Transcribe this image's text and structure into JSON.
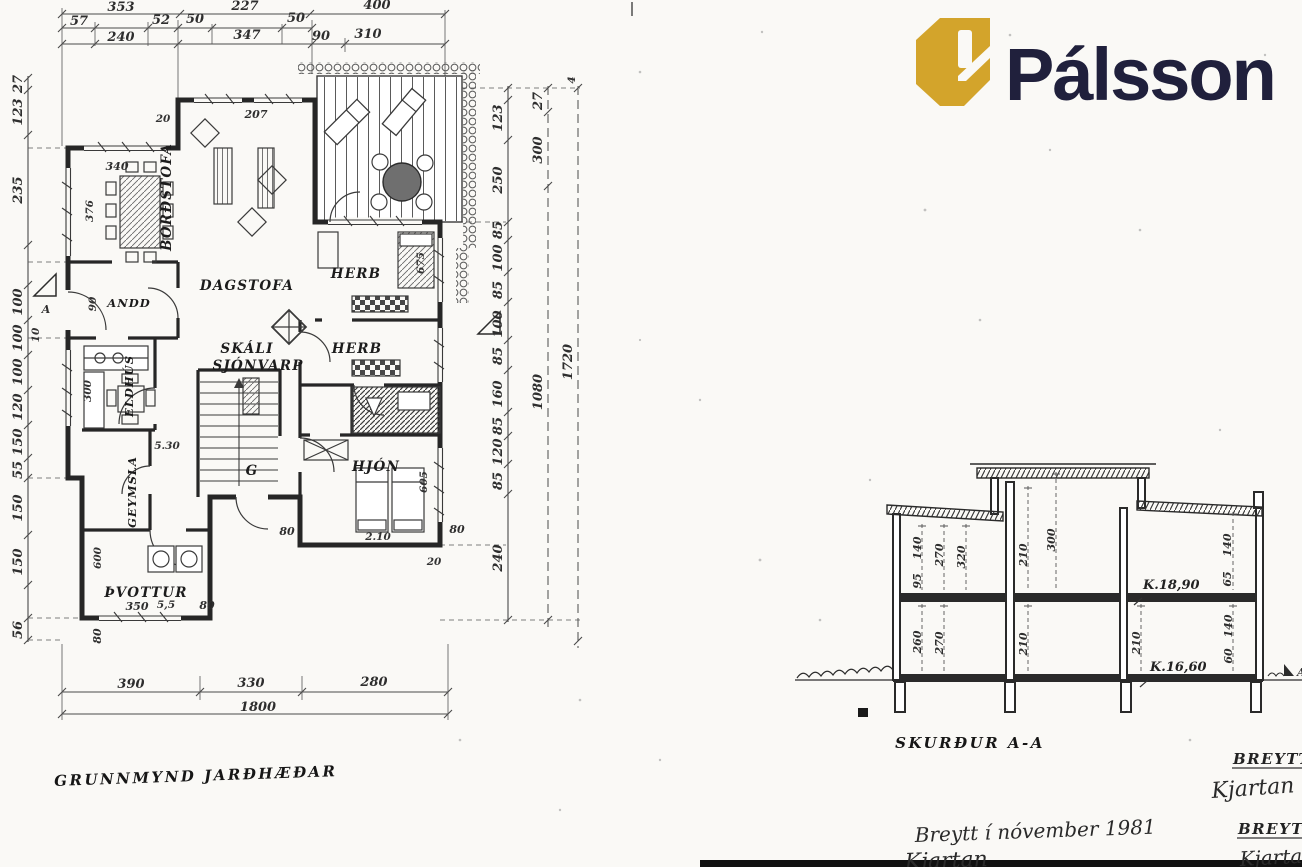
{
  "brand": {
    "name": "Pálsson",
    "gold": "#d3a42b",
    "navy": "#20203c"
  },
  "titles": {
    "plan": "GRUNNMYND JARÐHÆÐAR",
    "section": "SKURÐUR A-A"
  },
  "handwriting": {
    "note": "Breytt í nóvember 1981",
    "signature": "Kjartan",
    "signature_right": "Kjartan S",
    "revision_label_1": "BREYTT",
    "revision_label_2": "BREYTT"
  },
  "rooms": {
    "bordstofa": "BORÐSTOFA",
    "dagstofa": "DAGSTOFA",
    "andd": "ANDD",
    "skali": "SKÁLI",
    "sjonvarp": "SJÓNVARP",
    "eldhus": "ELDHÚS",
    "herb_1": "HERB",
    "herb_2": "HERB",
    "hjon": "HJÓN",
    "geymsla": "GEYMSLA",
    "gangur": "G",
    "thvottur": "ÞVOTTUR"
  },
  "markers": {
    "section_cut": "A",
    "section_end": "A"
  },
  "dims": {
    "top1": [
      "353",
      "227",
      "400"
    ],
    "top2": [
      "57",
      "52",
      "50",
      "50"
    ],
    "top3": [
      "240",
      "347",
      "90",
      "310"
    ],
    "left": [
      "27",
      "123",
      "235",
      "100",
      "100",
      "100",
      "120",
      "150",
      "55",
      "150",
      "150",
      "56"
    ],
    "left_inner": {
      "window": "376",
      "door": "90",
      "window2": "300",
      "wall": "600",
      "step": "10"
    },
    "right_a": [
      "123",
      "250",
      "85",
      "100",
      "85",
      "100",
      "85",
      "160",
      "85",
      "120",
      "85",
      "240"
    ],
    "right_b": [
      "27",
      "300",
      "1080"
    ],
    "right_c": [
      "1720",
      "4"
    ],
    "bottom": [
      "390",
      "330",
      "280"
    ],
    "bottom_total": "1800",
    "misc": {
      "a": "20",
      "b": "207",
      "c": "340",
      "d": "5.30",
      "e": "2.10",
      "f": "605",
      "g": "675",
      "h": "350",
      "i": "5,5",
      "j": "80",
      "k": "80",
      "l": "80",
      "m": "80",
      "n": "20"
    }
  },
  "section": {
    "levels": [
      "K.18,90",
      "K.16,60"
    ],
    "upper": [
      "140",
      "95",
      "270",
      "320",
      "210",
      "300",
      "140",
      "65"
    ],
    "lower": [
      "260",
      "270",
      "210",
      "210",
      "140",
      "60"
    ]
  }
}
